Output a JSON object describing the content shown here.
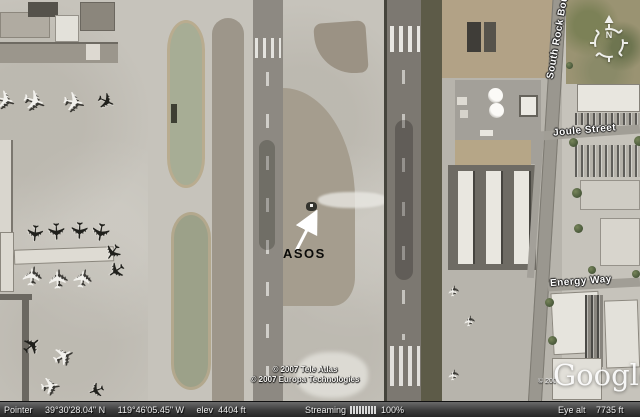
{
  "icons": {
    "aircraft": "✈"
  },
  "map": {
    "labels": {
      "asos": "ASOS",
      "joule_street": "Joule Street",
      "energy_way": "Energy Way",
      "south_rock_blvd": "South Rock Boul",
      "compass_north": "N"
    },
    "attribution": {
      "line1": "© 2007 Tele Atlas",
      "line2": "© 2007 Europa Technologies",
      "fragment": "© 2007",
      "google": "Google"
    }
  },
  "status_bar": {
    "pointer_label": "Pointer",
    "latitude": "39°30'28.04\" N",
    "longitude": "119°46'05.45\" W",
    "elev_label": "elev",
    "elevation_value": "4404 ft",
    "streaming_label": "Streaming",
    "streaming_value": "100%",
    "eye_alt_label": "Eye alt",
    "eye_alt_value": "7735 ft"
  }
}
